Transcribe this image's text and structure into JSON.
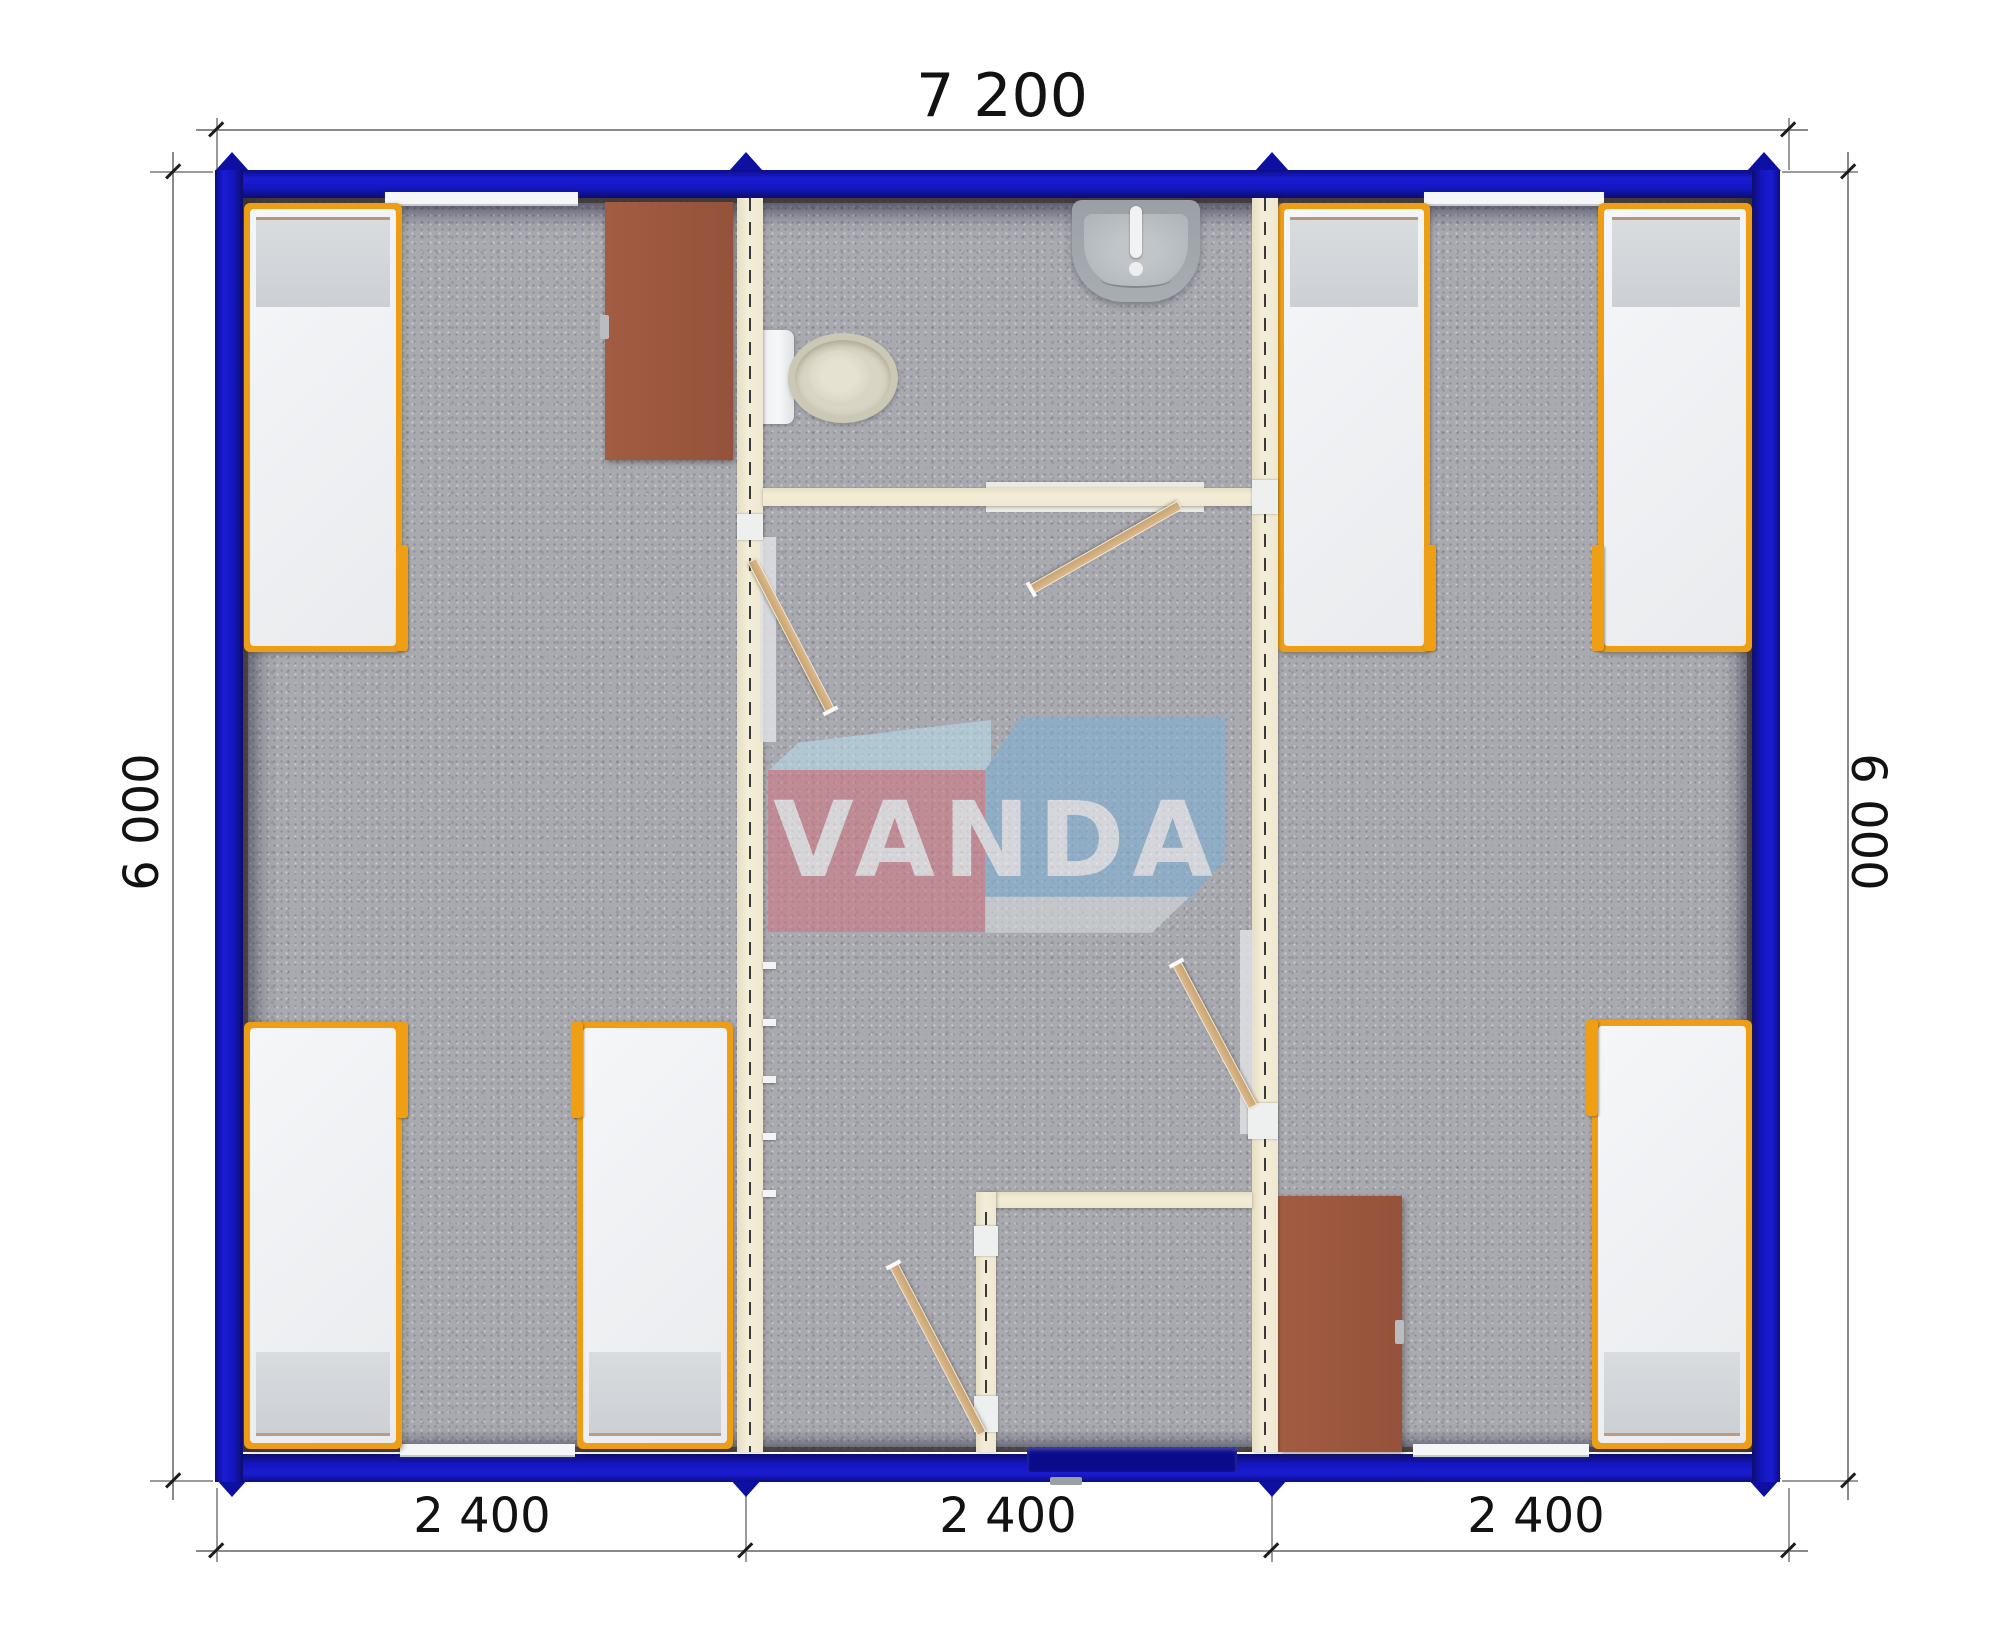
{
  "plan": {
    "type": "modular container house floor plan, top view",
    "modules": 3,
    "beds": 6,
    "desks": 2,
    "bathroom_fixtures": [
      "toilet",
      "sink"
    ],
    "doors": [
      "entrance-door",
      "bathroom-door",
      "left-room-door",
      "right-room-door",
      "vestibule-door"
    ]
  },
  "dimensions": {
    "top": "7 200",
    "bottom": [
      "2 400",
      "2 400",
      "2 400"
    ],
    "left": "6 000",
    "right": "6 000"
  },
  "logo": {
    "text": "VANDA"
  },
  "colors": {
    "wall_blue": "#1416c0",
    "peg_blue": "#0e10a2",
    "partition_cream": "#efe8d0",
    "carpet_gray": "#a9aab0",
    "bed_frame_orange": "#ed9e15",
    "mattress_white": "#f3f4f6",
    "desk_brown": "#9c5840",
    "logo_red": "#d07583",
    "logo_blue": "#7fb0d6",
    "door_wood": "#d2a979",
    "entry_door_navy": "#0a0b8a"
  }
}
